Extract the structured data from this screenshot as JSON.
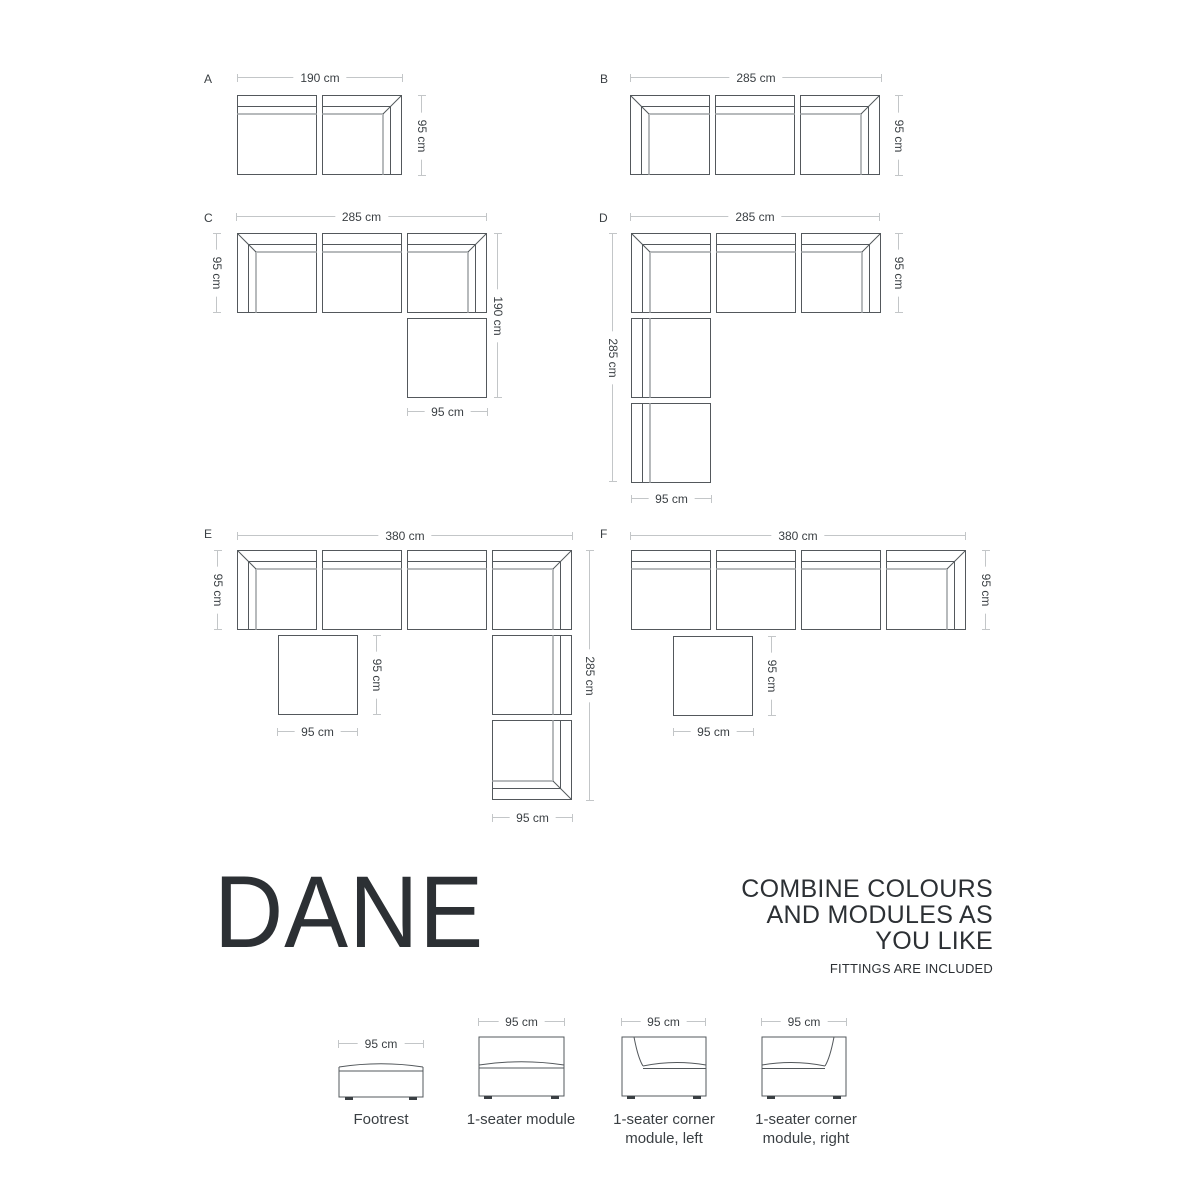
{
  "brand": {
    "title": "DANE"
  },
  "tagline": [
    "COMBINE COLOURS",
    "AND MODULES AS",
    "YOU LIKE"
  ],
  "note": "FITTINGS ARE INCLUDED",
  "colors": {
    "outline": "#53585c",
    "seat_line": "#b7babc",
    "dimension_line": "#c3c6c8",
    "text": "#3a3f43",
    "title_text": "#2c3034"
  },
  "configs": [
    {
      "label": "A",
      "dims": {
        "top": "190 cm",
        "right": "95 cm"
      }
    },
    {
      "label": "B",
      "dims": {
        "top": "285 cm",
        "right": "95 cm"
      }
    },
    {
      "label": "C",
      "dims": {
        "top": "285 cm",
        "left": "95 cm",
        "right": "190 cm",
        "bottom": "95 cm"
      }
    },
    {
      "label": "D",
      "dims": {
        "top": "285 cm",
        "left": "285 cm",
        "right": "95 cm",
        "bottom": "95 cm"
      }
    },
    {
      "label": "E",
      "dims": {
        "top": "380 cm",
        "left": "95 cm",
        "right": "285 cm",
        "bottom": "95 cm",
        "footrest_right": "95 cm",
        "footrest_bottom": "95 cm"
      }
    },
    {
      "label": "F",
      "dims": {
        "top": "380 cm",
        "right": "95 cm",
        "footrest_right": "95 cm",
        "footrest_bottom": "95 cm"
      }
    }
  ],
  "modules": [
    {
      "dim": "95 cm",
      "lines": [
        "Footrest"
      ]
    },
    {
      "dim": "95 cm",
      "lines": [
        "1-seater module"
      ]
    },
    {
      "dim": "95 cm",
      "lines": [
        "1-seater corner",
        "module, left"
      ]
    },
    {
      "dim": "95 cm",
      "lines": [
        "1-seater corner",
        "module, right"
      ]
    }
  ]
}
